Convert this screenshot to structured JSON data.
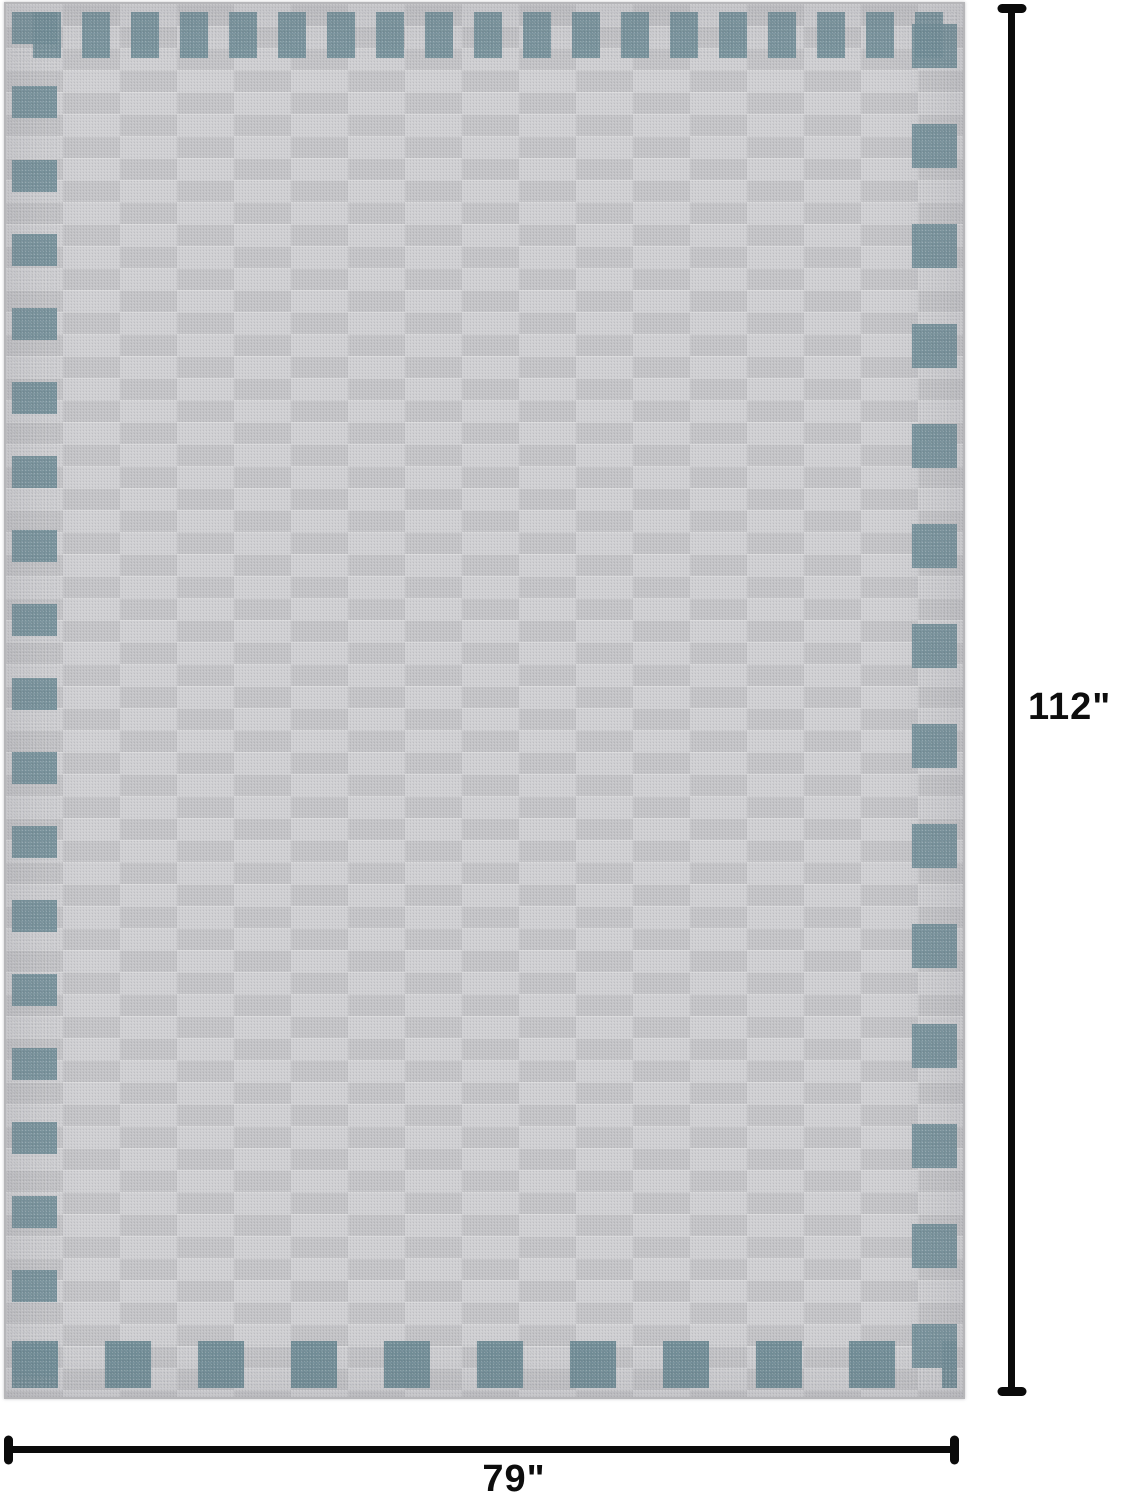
{
  "dimensions": {
    "height_label": "112\"",
    "width_label": "79\""
  },
  "colors": {
    "background": "#ffffff",
    "dimension_line": "#0b0b0b",
    "rug_base_gray": "#c7c7c9",
    "rug_brick_dark": "#c1c1c4",
    "rug_brick_light": "#cdcdd0",
    "rug_accent_teal": "#718e98"
  }
}
